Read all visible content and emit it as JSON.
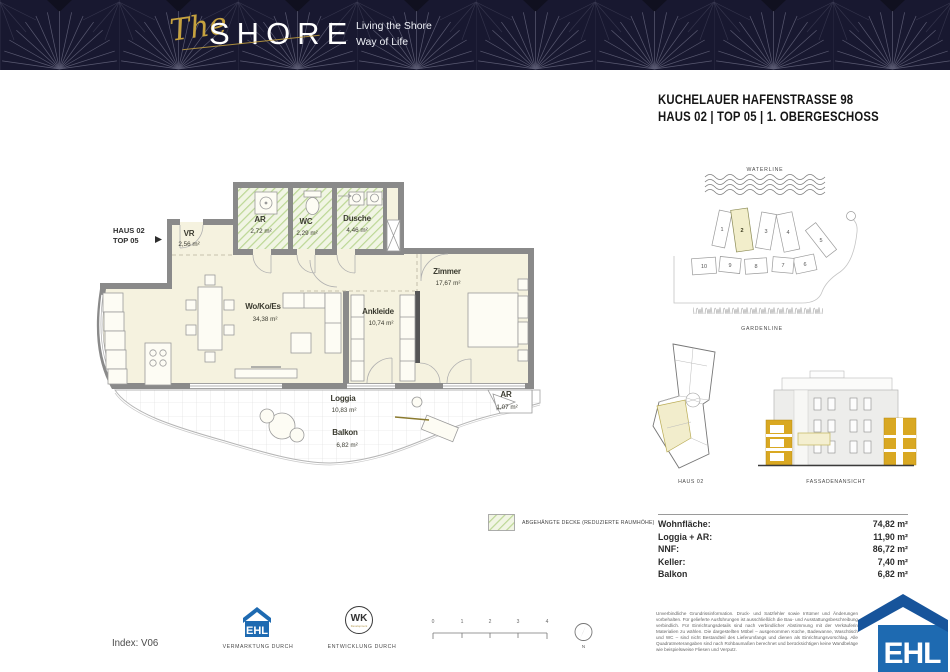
{
  "header": {
    "brand_the": "The",
    "brand_shore": "SHORE",
    "tagline_line1": "Living the Shore",
    "tagline_line2": "Way of Life"
  },
  "title": {
    "line1": "KUCHELAUER HAFENSTRASSE 98",
    "line2": "HAUS 02 | TOP 05 | 1. OBERGESCHOSS"
  },
  "floorplan": {
    "pointer_line1": "HAUS 02",
    "pointer_line2": "TOP 05",
    "rooms": {
      "vr": {
        "name": "VR",
        "area": "2,56 m²"
      },
      "ar": {
        "name": "AR",
        "area": "2,72 m²"
      },
      "wc": {
        "name": "WC",
        "area": "2,29 m²"
      },
      "dusche": {
        "name": "Dusche",
        "area": "4,46 m²"
      },
      "wohn": {
        "name": "Wo/Ko/Es",
        "area": "34,38 m²"
      },
      "ankleide": {
        "name": "Ankleide",
        "area": "10,74 m²"
      },
      "zimmer": {
        "name": "Zimmer",
        "area": "17,67 m²"
      },
      "loggia": {
        "name": "Loggia",
        "area": "10,83 m²"
      },
      "balkon": {
        "name": "Balkon",
        "area": "6,82 m²"
      },
      "ar2": {
        "name": "AR",
        "area": "1,07 m²"
      }
    }
  },
  "siteplan": {
    "waterline": "WATERLINE",
    "gardenline": "GARDENLINE",
    "buildings": [
      "1",
      "2",
      "3",
      "4",
      "5",
      "6",
      "7",
      "8",
      "9",
      "10"
    ],
    "highlighted": "2"
  },
  "keyplan": {
    "label": "HAUS 02"
  },
  "facade": {
    "label": "FASSADENANSICHT"
  },
  "legend": {
    "text": "ABGEHÄNGTE DECKE (REDUZIERTE RAUMHÖHE)"
  },
  "areas": {
    "rows": [
      {
        "label": "Wohnfläche:",
        "value": "74,82 m²"
      },
      {
        "label": "Loggia + AR:",
        "value": "11,90 m²"
      },
      {
        "label": "NNF:",
        "value": "86,72 m²"
      },
      {
        "label": "Keller:",
        "value": "7,40 m²"
      },
      {
        "label": "Balkon",
        "value": "6,82 m²"
      }
    ]
  },
  "footer": {
    "index": "Index: V06",
    "ehl_label": "VERMARKTUNG DURCH",
    "wk_label": "ENTWICKLUNG DURCH",
    "ehl_logo_text": "EHL",
    "wk_logo_text": "WK",
    "wk_logo_sub": "Development",
    "scale_ticks": [
      "0",
      "1",
      "2",
      "3",
      "4"
    ],
    "north": "N",
    "disclaimer": "Unverbindliche Grundrissinformation. Druck- und Satzfehler sowie Irrtümer und Änderungen vorbehalten. Für gelieferte Ausführungen ist ausschließlich die Bau- und Ausstattungsbeschreibung verbindlich. Für Einrichtungsdetails sind nach verbindlicher Abstimmung mit der Verkäuferin Materialien zu wählen. Die dargestellten Möbel – ausgenommen Küche, Badewanne, Waschtisch und WC – sind nicht Bestandteil des Lieferumfangs und dienen als Einrichtungsvorschlag. Alle Quadratmeterangaben sind nach Rohbaumaßen berechnet und berücksichtigen keine Wandbeläge wie beispielsweise Fliesen und Verputz."
  },
  "colors": {
    "navy": "#181830",
    "gold": "#c6a23f",
    "cream": "#f5f2df",
    "wall_gray": "#8a8a8a",
    "hatch_green": "#bcd795",
    "facade_yellow": "#d9a822",
    "ehl_blue": "#1e6ab1"
  }
}
